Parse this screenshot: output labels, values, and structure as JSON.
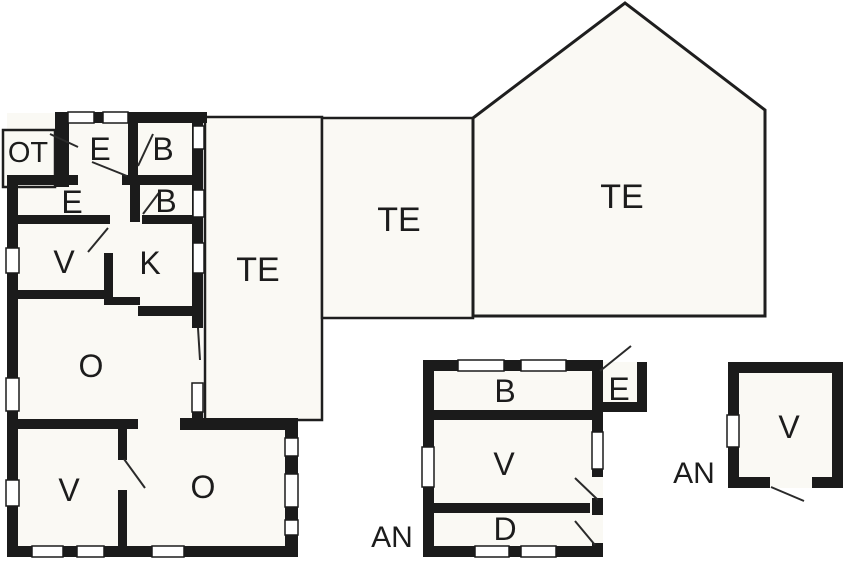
{
  "plan": {
    "type": "floor-plan",
    "colors": {
      "wall": "#1b1b1b",
      "room_fill": "#faf9f4",
      "background": "#ffffff",
      "door_line": "#2a2a2a"
    },
    "main_building": {
      "rooms": [
        {
          "id": "porch",
          "label": "OT"
        },
        {
          "id": "entry-1",
          "label": "E"
        },
        {
          "id": "bath-1",
          "label": "B"
        },
        {
          "id": "entry-2",
          "label": "E"
        },
        {
          "id": "bath-2",
          "label": "B"
        },
        {
          "id": "room-v-upper",
          "label": "V"
        },
        {
          "id": "kitchen",
          "label": "K"
        },
        {
          "id": "room-o-mid",
          "label": "O"
        },
        {
          "id": "room-v-lower",
          "label": "V"
        },
        {
          "id": "room-o-lower",
          "label": "O"
        }
      ]
    },
    "terraces": [
      {
        "id": "terrace-1",
        "label": "TE"
      },
      {
        "id": "terrace-2",
        "label": "TE"
      },
      {
        "id": "terrace-3-pentagon",
        "label": "TE"
      }
    ],
    "annexes": [
      {
        "id": "annex-1",
        "label": "AN",
        "rooms": [
          {
            "id": "annex1-b",
            "label": "B"
          },
          {
            "id": "annex1-e",
            "label": "E"
          },
          {
            "id": "annex1-v",
            "label": "V"
          },
          {
            "id": "annex1-d",
            "label": "D"
          }
        ]
      },
      {
        "id": "annex-2",
        "label": "AN",
        "rooms": [
          {
            "id": "annex2-v",
            "label": "V"
          }
        ]
      }
    ]
  }
}
